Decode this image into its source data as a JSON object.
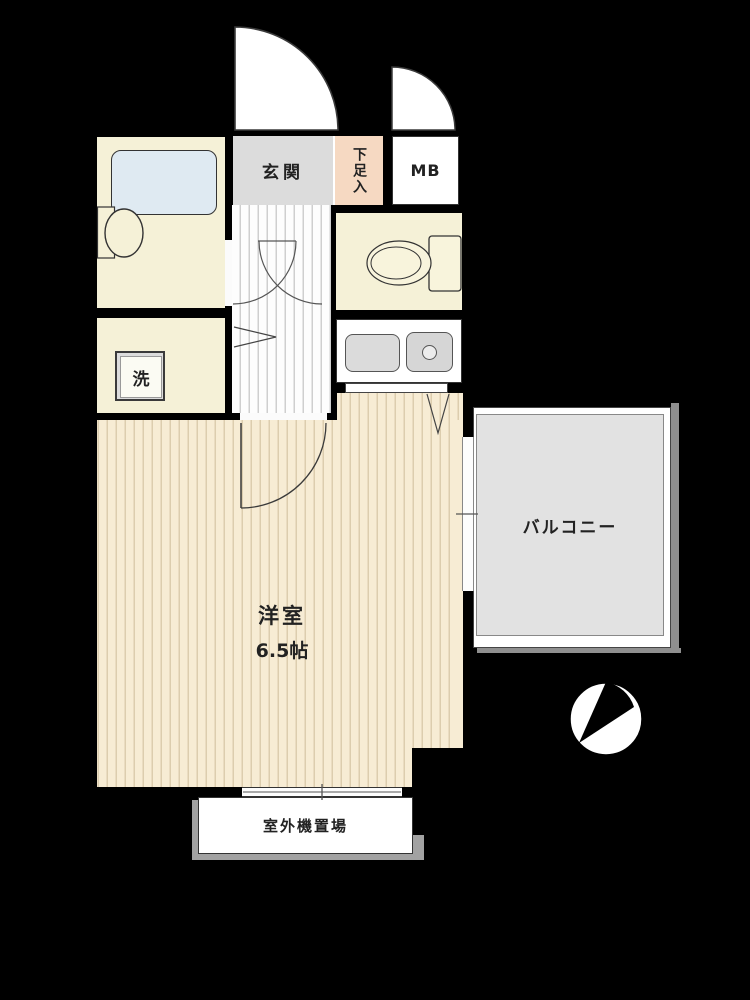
{
  "plan": {
    "type": "apartment-floor-plan",
    "rooms": {
      "entrance": {
        "label": "玄関"
      },
      "shoe_cabinet": {
        "label": "下足入"
      },
      "meter_box": {
        "label": "MB"
      },
      "laundry": {
        "label": "洗"
      },
      "western_room": {
        "label": "洋室",
        "size": "6.5帖"
      },
      "balcony": {
        "label": "バルコニー"
      },
      "outdoor_unit_area": {
        "label": "室外機置場"
      }
    },
    "fixtures": [
      "bathtub",
      "washbasin",
      "toilet",
      "kitchen-sink",
      "stove",
      "north-compass"
    ],
    "colors": {
      "background": "#000000",
      "room_cream": "#f5f1d7",
      "flooring_base": "#f7ecd4",
      "flooring_stripe": "#dccdae",
      "corridor_base": "#fdfdfd",
      "corridor_stripe": "#cfcfcf",
      "entrance_gray": "#dcdcdc",
      "shoe_cabinet_salmon": "#f6d9c2",
      "balcony_gray": "#e2e2e2",
      "bathtub_blue": "#dfeaf2",
      "shadow_gray": "#8f8f8f",
      "line": "#333333"
    }
  }
}
